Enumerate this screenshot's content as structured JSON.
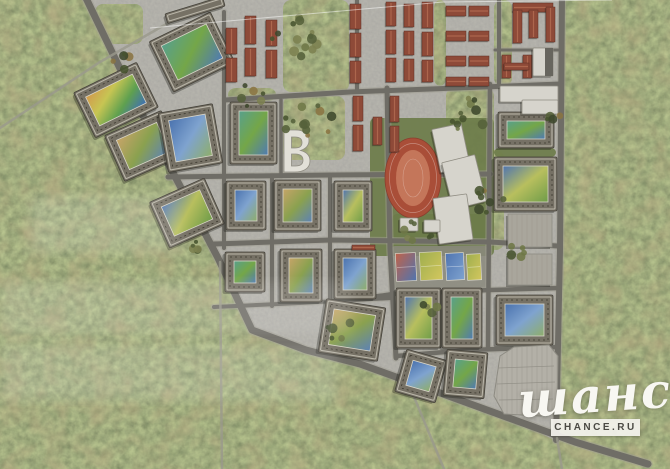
{
  "watermark": {
    "script_text": "шанс",
    "box_text": "CHANCE.RU"
  },
  "palette": {
    "forest_base": "#4f5a35",
    "ground": "#81807a",
    "road": "#6f6d66",
    "road_edge": "#a09d91",
    "trail": "#9a988c",
    "building": "#767165",
    "building_stroke": "#45423a",
    "roof_line": "#b9b5a8",
    "roof_dash": "#3c392f",
    "court_edge": "#d8d5c8",
    "red_roof": "#8e4a38",
    "red_ridge": "#b06a50",
    "red_stroke": "#5f2f24",
    "white_bldg": "#d6d4cc",
    "white_stroke": "#8f8c82",
    "dark_section": "#67655e",
    "track": "#a94e38",
    "track_stroke": "#8a3f2e",
    "infield": "#c4765a",
    "lawn": "#6d7c4a",
    "parking": "#b3b0a7",
    "parking_stroke": "#8d8b82",
    "stall_line": "#97948b",
    "hatched": "#a9a69c",
    "plaza": "#8b897e",
    "shadow": "rgba(30,28,22,0.35)",
    "wm_text": "#f8f7f2",
    "wm_box_bg": "rgba(244,243,238,0.92)",
    "wm_box_text": "#4b4a44"
  },
  "gradients": {
    "play1": [
      "#58a08c",
      "#74a648",
      "#4f7ab3"
    ],
    "play2": [
      "#c6a468",
      "#8aa14f",
      "#5d82b5"
    ],
    "play3": [
      "#4f74b0",
      "#b8bf5e",
      "#6f9c49"
    ],
    "play4": [
      "#d29a4e",
      "#c7c553",
      "#5fa04f",
      "#3f6fb5"
    ],
    "play5": [
      "#4a72ae",
      "#7fa3cf",
      "#8fae6a"
    ],
    "courtA": [
      "#c0634a",
      "#4f74b0"
    ],
    "courtB": [
      "#9fae4e",
      "#d3c75e"
    ],
    "courtC": [
      "#4f74b0",
      "#7fa3cf"
    ]
  },
  "map": {
    "dev_outline": "83,-4 562,-4 560,250 556,441 520,422 443,394 360,364 306,350 252,330 218,258 140,110",
    "tree_colors": [
      "#55613a",
      "#47532f",
      "#6e7747",
      "#7c8150",
      "#8a7442",
      "#3d482c"
    ],
    "tree_patches": [
      [
        283,
        0,
        66,
        92
      ],
      [
        283,
        96,
        62,
        64
      ],
      [
        446,
        88,
        48,
        68
      ],
      [
        478,
        150,
        26,
        100
      ],
      [
        494,
        0,
        18,
        86
      ],
      [
        95,
        4,
        48,
        40
      ],
      [
        434,
        0,
        12,
        86
      ],
      [
        228,
        88,
        48,
        13
      ],
      [
        308,
        352,
        34,
        12
      ]
    ],
    "lawns": [
      [
        370,
        118,
        124,
        138
      ],
      [
        392,
        214,
        96,
        34
      ],
      [
        494,
        148,
        62,
        9
      ],
      [
        445,
        232,
        44,
        16
      ]
    ],
    "plaza": [
      392,
      246,
      96,
      42
    ],
    "roads_major": [
      {
        "w": 7,
        "pts": [
          [
            85,
            -4
          ],
          [
            140,
            110
          ],
          [
            218,
            258
          ],
          [
            252,
            330
          ],
          [
            306,
            350
          ],
          [
            360,
            364
          ],
          [
            443,
            394
          ],
          [
            520,
            422
          ],
          [
            575,
            442
          ],
          [
            648,
            464
          ]
        ]
      },
      {
        "w": 6,
        "pts": [
          [
            562,
            -4
          ],
          [
            560,
            250
          ],
          [
            556,
            440
          ]
        ]
      },
      {
        "w": 5,
        "pts": [
          [
            225,
            100
          ],
          [
            350,
            92
          ],
          [
            560,
            84
          ]
        ]
      },
      {
        "w": 5,
        "pts": [
          [
            168,
            177
          ],
          [
            330,
            175
          ],
          [
            490,
            174
          ]
        ]
      },
      {
        "w": 5,
        "pts": [
          [
            214,
            244
          ],
          [
            330,
            240
          ],
          [
            490,
            242
          ],
          [
            558,
            246
          ]
        ]
      },
      {
        "w": 4.5,
        "pts": [
          [
            330,
            303
          ],
          [
            393,
            294
          ],
          [
            490,
            290
          ],
          [
            558,
            288
          ]
        ]
      },
      {
        "w": 4.5,
        "pts": [
          [
            396,
            356
          ],
          [
            470,
            350
          ],
          [
            558,
            347
          ]
        ]
      },
      {
        "w": 4,
        "pts": [
          [
            214,
            307
          ],
          [
            300,
            303
          ],
          [
            392,
            298
          ]
        ]
      },
      {
        "w": 4,
        "pts": [
          [
            224,
            12
          ],
          [
            224,
            248
          ]
        ]
      },
      {
        "w": 4,
        "pts": [
          [
            272,
            176
          ],
          [
            272,
            306
          ]
        ]
      },
      {
        "w": 3.5,
        "pts": [
          [
            281,
            100
          ],
          [
            281,
            176
          ]
        ]
      },
      {
        "w": 4,
        "pts": [
          [
            330,
            176
          ],
          [
            330,
            306
          ]
        ]
      },
      {
        "w": 5,
        "pts": [
          [
            387,
            88
          ],
          [
            390,
            250
          ],
          [
            396,
            358
          ]
        ]
      },
      {
        "w": 4.5,
        "pts": [
          [
            490,
            84
          ],
          [
            488,
            348
          ]
        ]
      },
      {
        "w": 4,
        "pts": [
          [
            357,
            0
          ],
          [
            357,
            90
          ]
        ]
      },
      {
        "w": 4,
        "pts": [
          [
            499,
            0
          ],
          [
            499,
            84
          ]
        ]
      },
      {
        "w": 3,
        "pts": [
          [
            495,
            50
          ],
          [
            558,
            50
          ]
        ]
      }
    ],
    "roads_minor": [
      {
        "w": 2.5,
        "pts": [
          [
            0,
            128
          ],
          [
            100,
            62
          ],
          [
            208,
            0
          ]
        ]
      },
      {
        "w": 2.5,
        "pts": [
          [
            220,
            262
          ],
          [
            222,
            469
          ]
        ]
      },
      {
        "w": 2.5,
        "pts": [
          [
            412,
            392
          ],
          [
            444,
            469
          ]
        ]
      },
      {
        "w": 2.5,
        "pts": [
          [
            557,
            438
          ],
          [
            562,
            469
          ]
        ]
      }
    ],
    "blocks": [
      {
        "x": 158,
        "y": 24,
        "w": 68,
        "h": 56,
        "rot": -26,
        "c": "play1"
      },
      {
        "x": 81,
        "y": 75,
        "w": 70,
        "h": 50,
        "rot": -26,
        "c": "play4"
      },
      {
        "x": 112,
        "y": 121,
        "w": 62,
        "h": 50,
        "rot": -24,
        "c": "play2"
      },
      {
        "x": 163,
        "y": 108,
        "w": 55,
        "h": 60,
        "rot": -10,
        "c": "play5"
      },
      {
        "x": 230,
        "y": 102,
        "w": 47,
        "h": 62,
        "rot": 0,
        "c": "play1"
      },
      {
        "x": 157,
        "y": 188,
        "w": 60,
        "h": 50,
        "rot": -24,
        "c": "play3"
      },
      {
        "x": 226,
        "y": 181,
        "w": 40,
        "h": 49,
        "rot": 0,
        "c": "play5"
      },
      {
        "x": 274,
        "y": 180,
        "w": 47,
        "h": 51,
        "rot": 0,
        "c": "play2"
      },
      {
        "x": 334,
        "y": 181,
        "w": 38,
        "h": 50,
        "rot": 0,
        "c": "play3"
      },
      {
        "x": 225,
        "y": 252,
        "w": 40,
        "h": 40,
        "rot": 0,
        "c": "play1"
      },
      {
        "x": 280,
        "y": 249,
        "w": 42,
        "h": 53,
        "rot": 0,
        "c": "play2"
      },
      {
        "x": 334,
        "y": 249,
        "w": 42,
        "h": 50,
        "rot": 0,
        "c": "play5"
      },
      {
        "x": 322,
        "y": 303,
        "w": 60,
        "h": 54,
        "rot": 9,
        "c": "play2"
      },
      {
        "x": 396,
        "y": 288,
        "w": 45,
        "h": 60,
        "rot": 0,
        "c": "play3"
      },
      {
        "x": 442,
        "y": 288,
        "w": 40,
        "h": 60,
        "rot": 0,
        "c": "play1"
      },
      {
        "x": 400,
        "y": 354,
        "w": 42,
        "h": 44,
        "rot": 16,
        "c": "play5"
      },
      {
        "x": 445,
        "y": 351,
        "w": 41,
        "h": 46,
        "rot": 5,
        "c": "play1"
      },
      {
        "x": 498,
        "y": 112,
        "w": 56,
        "h": 36,
        "rot": 0,
        "c": "play1"
      },
      {
        "x": 494,
        "y": 157,
        "w": 63,
        "h": 54,
        "rot": 0,
        "c": "play3"
      },
      {
        "x": 496,
        "y": 295,
        "w": 57,
        "h": 50,
        "rot": 0,
        "c": "play5"
      },
      {
        "x": 165,
        "y": 5,
        "w": 60,
        "h": 10,
        "rot": -17,
        "c": null
      }
    ],
    "townhouses": [
      [
        226,
        28,
        11,
        26
      ],
      [
        226,
        58,
        11,
        24
      ],
      [
        245,
        16,
        11,
        28
      ],
      [
        245,
        48,
        11,
        28
      ],
      [
        266,
        20,
        11,
        26
      ],
      [
        266,
        50,
        11,
        28
      ],
      [
        350,
        4,
        11,
        25
      ],
      [
        350,
        33,
        11,
        24
      ],
      [
        350,
        61,
        11,
        22
      ],
      [
        386,
        2,
        10,
        24
      ],
      [
        386,
        30,
        10,
        24
      ],
      [
        386,
        58,
        10,
        24
      ],
      [
        404,
        4,
        10,
        23
      ],
      [
        404,
        31,
        10,
        24
      ],
      [
        404,
        59,
        10,
        22
      ],
      [
        422,
        2,
        11,
        26
      ],
      [
        422,
        32,
        11,
        24
      ],
      [
        422,
        60,
        11,
        22
      ],
      [
        353,
        96,
        10,
        25
      ],
      [
        353,
        125,
        10,
        26
      ],
      [
        373,
        117,
        9,
        28
      ],
      [
        390,
        96,
        9,
        26
      ],
      [
        390,
        126,
        9,
        26
      ],
      [
        446,
        6,
        20,
        10
      ],
      [
        469,
        6,
        20,
        10
      ],
      [
        446,
        31,
        20,
        10
      ],
      [
        469,
        31,
        20,
        10
      ],
      [
        446,
        56,
        20,
        10
      ],
      [
        469,
        56,
        20,
        10
      ],
      [
        446,
        77,
        20,
        9
      ],
      [
        469,
        77,
        20,
        9
      ]
    ],
    "red_large": [
      [
        513,
        3,
        40,
        9
      ],
      [
        513,
        10,
        9,
        33
      ],
      [
        529,
        10,
        9,
        28
      ],
      [
        546,
        7,
        9,
        35
      ],
      [
        502,
        55,
        9,
        23
      ],
      [
        523,
        55,
        9,
        23
      ],
      [
        504,
        63,
        25,
        7
      ],
      [
        352,
        245,
        23,
        5
      ]
    ],
    "whites": [
      [
        500,
        86,
        58,
        16,
        0
      ],
      [
        522,
        100,
        36,
        14,
        0
      ],
      [
        533,
        48,
        20,
        28,
        0
      ],
      [
        436,
        126,
        30,
        44,
        -12
      ],
      [
        447,
        158,
        34,
        48,
        -14
      ],
      [
        436,
        196,
        34,
        46,
        -8
      ],
      [
        400,
        218,
        18,
        13,
        0
      ],
      [
        424,
        220,
        16,
        12,
        0
      ]
    ],
    "dark_sections": [
      [
        545,
        48,
        8,
        28
      ]
    ],
    "b_building": {
      "path": "M284 130 L295 130 C304 130 309 134 309 140.5 C309 145.5 305.5 148.8 300.5 150.5 C306.5 152 310 155.5 310 161 C310 168.5 303.5 172 294.5 172 L284 172 Z M291.5 137 L295 137 C299.5 137 302 139 302 142.5 C302 146 299.5 148 295 148 L291.5 148 Z M291.5 154 L295.5 154 C300.5 154 303 156.5 303 160 C303 163.8 300.5 166 295.5 166 L291.5 166 Z"
    },
    "stadium": {
      "cx": 413,
      "cy": 178,
      "rx": 28,
      "ry": 40
    },
    "courts": [
      [
        396,
        253,
        20,
        28,
        "courtA"
      ],
      [
        420,
        252,
        22,
        28,
        "courtB"
      ],
      [
        446,
        253,
        18,
        27,
        "courtC"
      ],
      [
        467,
        254,
        14,
        26,
        "courtB"
      ]
    ],
    "parking": {
      "pts": "500,356 514,347 549,345 558,356 557,410 541,416 504,414 494,396",
      "aisles": [
        [
          498,
          368,
          554,
          366
        ],
        [
          497,
          384,
          555,
          382
        ],
        [
          499,
          400,
          553,
          399
        ]
      ]
    },
    "hatched": [
      [
        508,
        214,
        44,
        33
      ],
      [
        508,
        254,
        44,
        31
      ]
    ],
    "tree_clusters": [
      {
        "x": 300,
        "y": 40,
        "r": 30,
        "n": 14
      },
      {
        "x": 310,
        "y": 125,
        "r": 26,
        "n": 12
      },
      {
        "x": 465,
        "y": 115,
        "r": 22,
        "n": 10
      },
      {
        "x": 488,
        "y": 200,
        "r": 16,
        "n": 8
      },
      {
        "x": 420,
        "y": 230,
        "r": 20,
        "n": 7
      },
      {
        "x": 250,
        "y": 95,
        "r": 14,
        "n": 6
      },
      {
        "x": 120,
        "y": 60,
        "r": 14,
        "n": 5
      },
      {
        "x": 200,
        "y": 250,
        "r": 12,
        "n": 5
      },
      {
        "x": 340,
        "y": 330,
        "r": 14,
        "n": 5
      },
      {
        "x": 520,
        "y": 250,
        "r": 12,
        "n": 5
      },
      {
        "x": 555,
        "y": 120,
        "r": 10,
        "n": 4
      },
      {
        "x": 430,
        "y": 310,
        "r": 10,
        "n": 4
      }
    ],
    "white_line": [
      [
        150,
        28
      ],
      [
        443,
        2
      ],
      [
        612,
        0
      ]
    ],
    "haze": [
      [
        0,
        282,
        352,
        54
      ],
      [
        0,
        344,
        336,
        56
      ],
      [
        30,
        196,
        150,
        56
      ]
    ]
  }
}
